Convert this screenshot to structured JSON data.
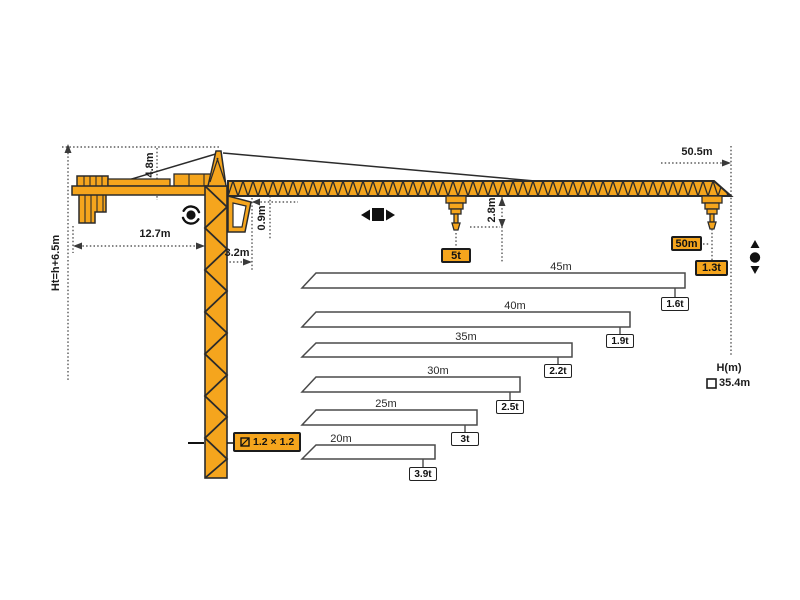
{
  "diagram": {
    "title": "Tower crane specification diagram",
    "colors": {
      "crane_orange": "#F5A51D",
      "line_dark": "#2b2b2b",
      "bar_outline": "#4a4a4a",
      "background": "#ffffff"
    },
    "dimensions": {
      "total_height": "Ht=h+6.5m",
      "tail_radius": "12.7m",
      "head_height": "4.8m",
      "jib_offset": "3.2m",
      "jib_depth": "0.9m",
      "hook_drop": "2.8m",
      "max_radius": "50.5m",
      "mast_section": "1.2 × 1.2",
      "height_axis": "H(m)",
      "freestanding_height": "35.4m"
    },
    "capacities": {
      "max_load": "5t",
      "tip_radius": "50m",
      "tip_load": "1.3t"
    },
    "icons": {
      "slewing": "rotation-icon",
      "trolley": "trolley-travel-icon",
      "hoist": "hook-updown-icon",
      "mast_section": "square-section-icon",
      "height_marker": "square-outline-icon"
    }
  },
  "chart_data": {
    "type": "bar",
    "title": "Jib length vs tip capacity",
    "categories": [
      "45m",
      "40m",
      "35m",
      "30m",
      "25m",
      "20m"
    ],
    "values": [
      1.6,
      1.9,
      2.2,
      2.5,
      3.0,
      3.9
    ],
    "unit": "t",
    "entries": [
      {
        "length": "45m",
        "capacity": "1.6t"
      },
      {
        "length": "40m",
        "capacity": "1.9t"
      },
      {
        "length": "35m",
        "capacity": "2.2t"
      },
      {
        "length": "30m",
        "capacity": "2.5t"
      },
      {
        "length": "25m",
        "capacity": "3t"
      },
      {
        "length": "20m",
        "capacity": "3.9t"
      }
    ]
  }
}
